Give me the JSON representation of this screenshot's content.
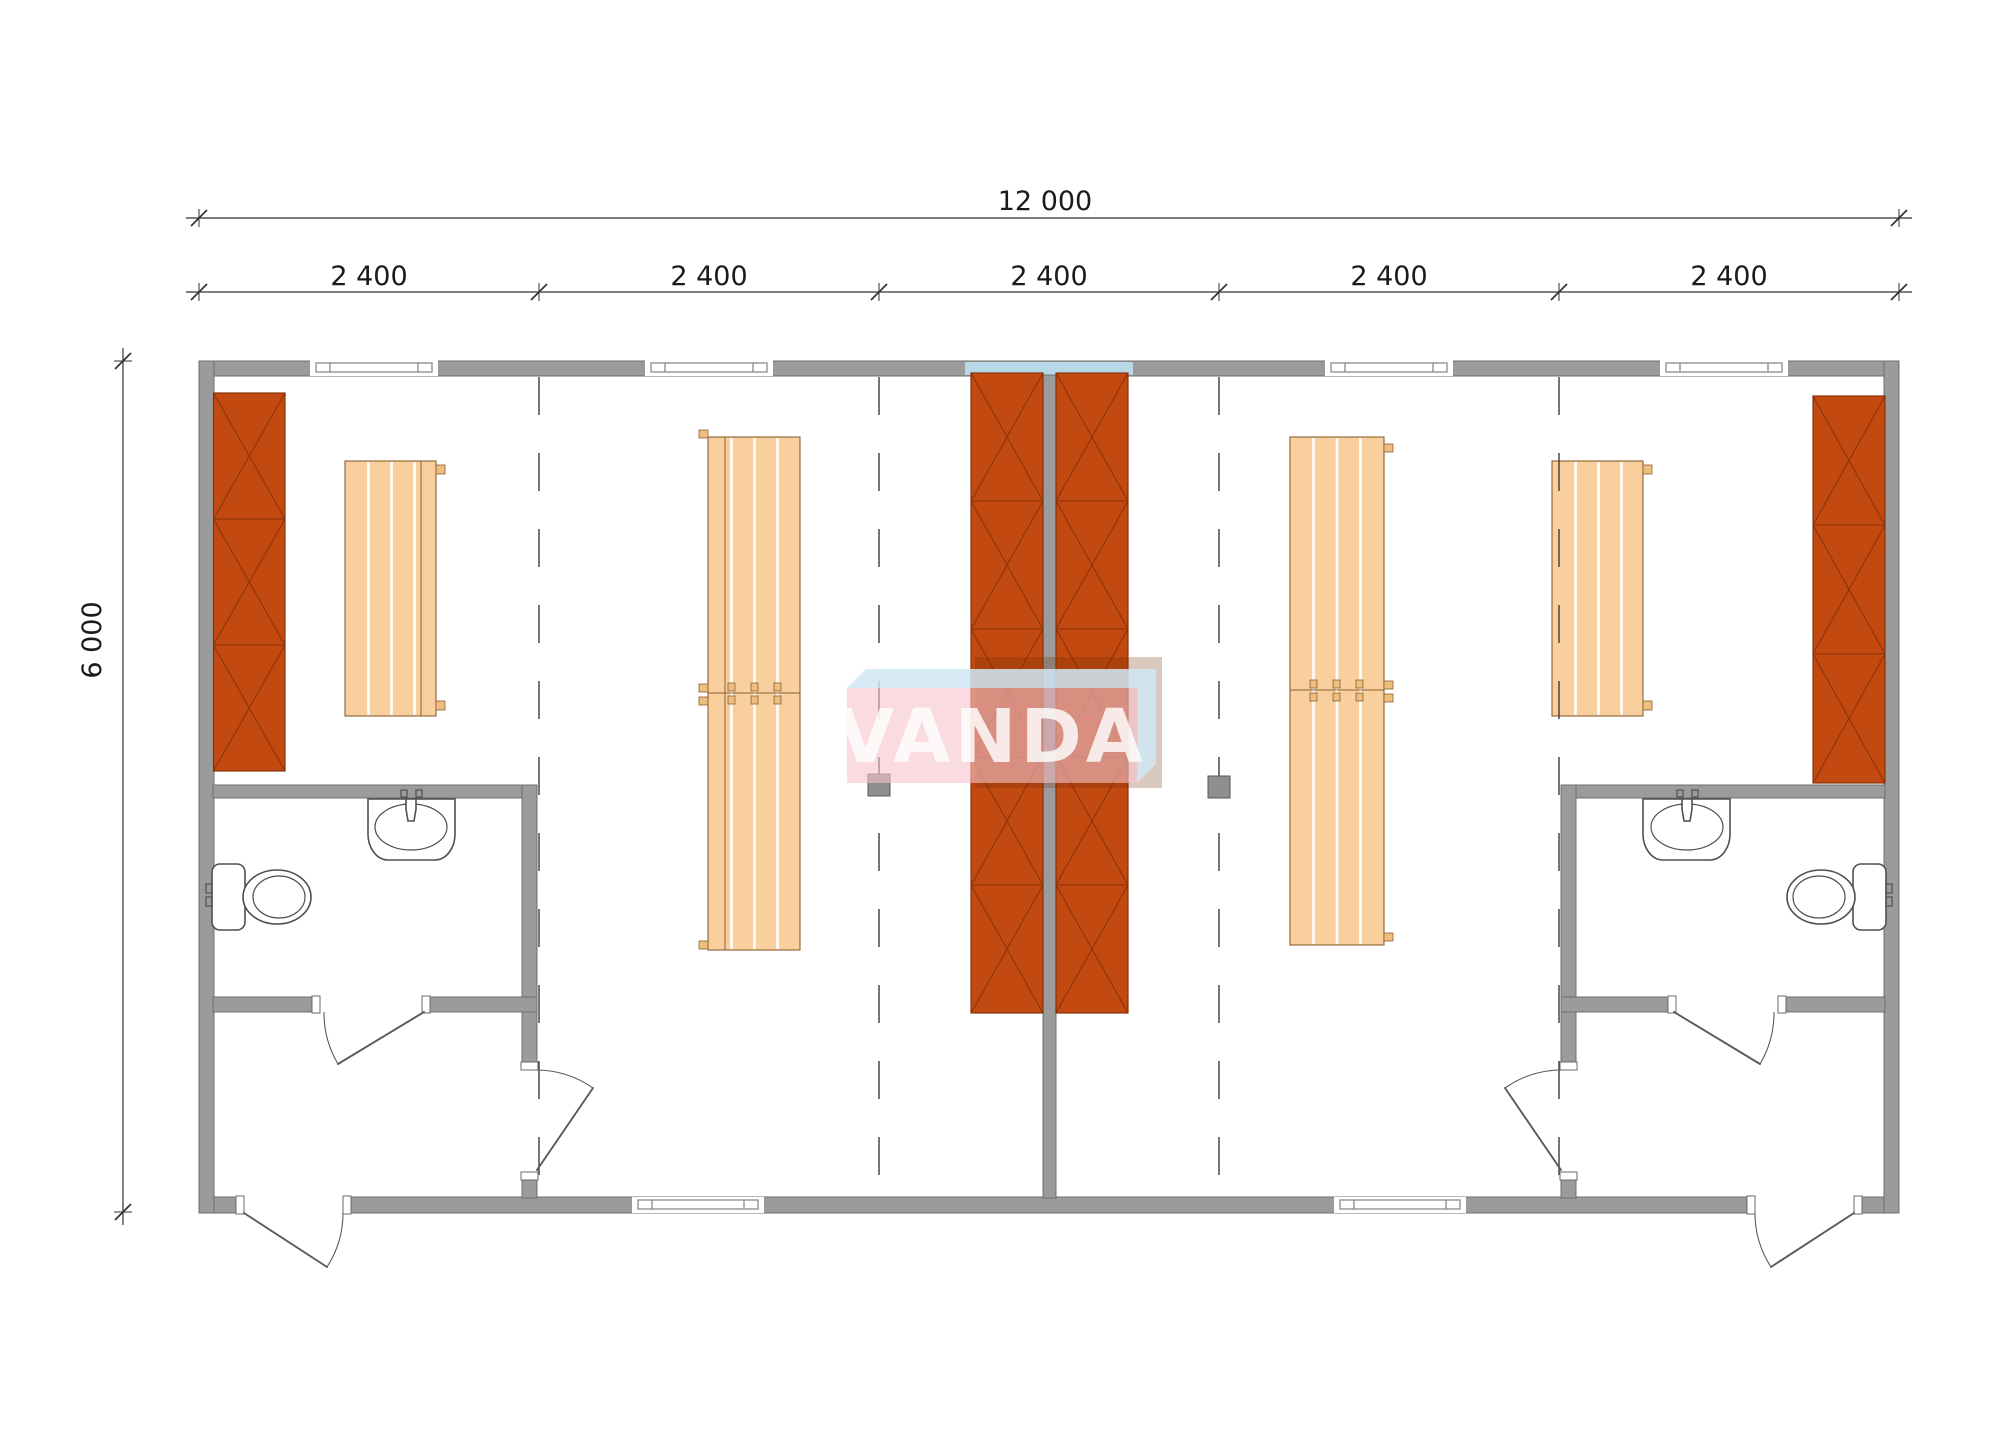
{
  "page": {
    "background": "#ffffff",
    "type": "architectural-floor-plan"
  },
  "dimensions": {
    "total_width_label": "12 000",
    "bay_labels": [
      "2 400",
      "2 400",
      "2 400",
      "2 400",
      "2 400"
    ],
    "height_label": "6 000"
  },
  "watermark": {
    "text": "VANDA"
  },
  "colors": {
    "page-bg": "#ffffff",
    "wall": "#9b9b9b",
    "wall-stroke": "#6f6f6f",
    "orange": "#c2490f",
    "orange-line": "#87330a",
    "bench": "#f8cf9d",
    "bench-stroke": "#8a6134",
    "tab": "#eebe7f",
    "blue": "#b9d8e8",
    "fixture-stroke": "#4f4f4f",
    "door-stroke": "#5a5a5a",
    "dash": "#3c3c3c",
    "drain": "#8f8f8f",
    "dim": "#1a1a1a",
    "logo-pink": "#f6c3cd",
    "logo-blue": "#cfe8f4",
    "logo-shadow": "#6b2f08",
    "logo-text": "#ffffff"
  }
}
